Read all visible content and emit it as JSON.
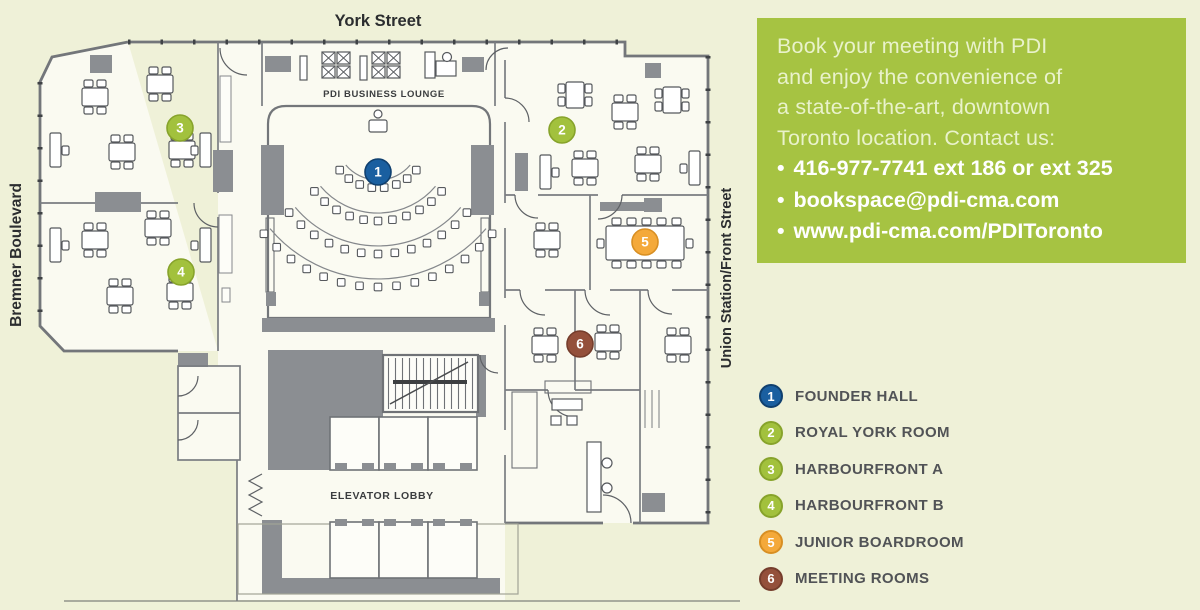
{
  "page": {
    "background": "#eff1d8"
  },
  "streets": {
    "top": "York Street",
    "left": "Bremner Boulevard",
    "right": "Union Station/Front Street"
  },
  "plan_labels": {
    "business_lounge": "PDI BUSINESS LOUNGE",
    "elevator_lobby": "ELEVATOR LOBBY"
  },
  "info_box": {
    "bg": "#a6c342",
    "intro_lines": [
      "Book your meeting with PDI",
      "and enjoy the convenience of",
      "a state-of-the-art, downtown",
      "Toronto location. Contact us:"
    ],
    "bullet": "•",
    "bullets": [
      "416-977-7741 ext 186 or ext 325",
      "bookspace@pdi-cma.com",
      "www.pdi-cma.com/PDIToronto"
    ]
  },
  "rooms": [
    {
      "num": "1",
      "label": "FOUNDER HALL",
      "color": "#1a5fa0",
      "border": "#10406f"
    },
    {
      "num": "2",
      "label": "ROYAL YORK ROOM",
      "color": "#a2c13d",
      "border": "#87a32b"
    },
    {
      "num": "3",
      "label": "HARBOURFRONT A",
      "color": "#a2c13d",
      "border": "#87a32b"
    },
    {
      "num": "4",
      "label": "HARBOURFRONT B",
      "color": "#a2c13d",
      "border": "#87a32b"
    },
    {
      "num": "5",
      "label": "JUNIOR BOARDROOM",
      "color": "#f4a93a",
      "border": "#d88f23"
    },
    {
      "num": "6",
      "label": "MEETING ROOMS",
      "color": "#94503b",
      "border": "#753d2c"
    }
  ]
}
